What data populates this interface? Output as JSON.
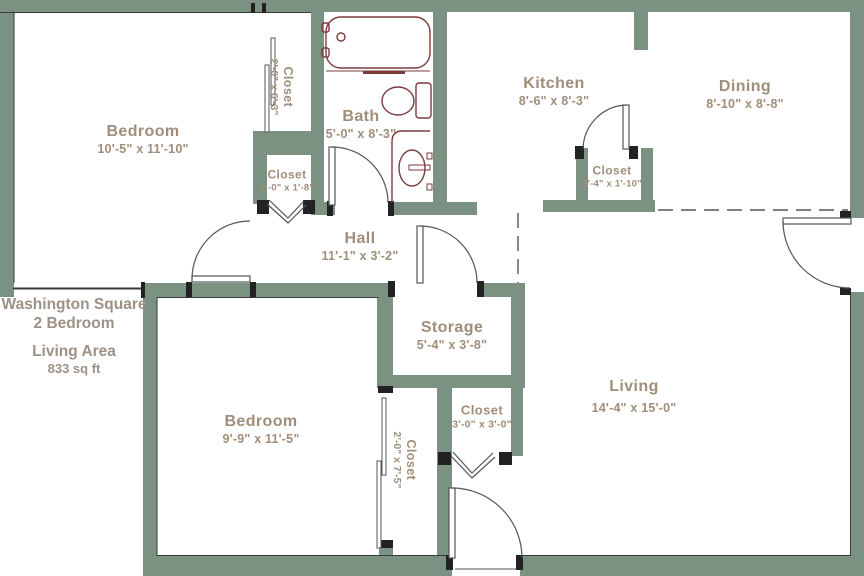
{
  "title": {
    "line1": "Washington Square",
    "line2": "2 Bedroom",
    "line3": "Living Area",
    "line4": "833 sq ft"
  },
  "rooms": {
    "bedroom1": {
      "name": "Bedroom",
      "dims": "10'-5\" x 11'-10\""
    },
    "closet1": {
      "name": "Closet",
      "dims": "2'-0\" x 6'-3\""
    },
    "closet2": {
      "name": "Closet",
      "dims": "2'-0\" x 1'-8\""
    },
    "bath": {
      "name": "Bath",
      "dims": "5'-0\" x 8'-3\""
    },
    "kitchen": {
      "name": "Kitchen",
      "dims": "8'-6\" x 8'-3\""
    },
    "kitchen_closet": {
      "name": "Closet",
      "dims": "2'-4\" x 1'-10\""
    },
    "dining": {
      "name": "Dining",
      "dims": "8'-10\" x 8'-8\""
    },
    "hall": {
      "name": "Hall",
      "dims": "11'-1\" x 3'-2\""
    },
    "storage": {
      "name": "Storage",
      "dims": "5'-4\" x 3'-8\""
    },
    "closet3": {
      "name": "Closet",
      "dims": "3'-0\" x 3'-0\""
    },
    "closet4": {
      "name": "Closet",
      "dims": "2'-0\" x 7'-5\""
    },
    "bedroom2": {
      "name": "Bedroom",
      "dims": "9'-9\" x 11'-5\""
    },
    "living": {
      "name": "Living",
      "dims": "14'-4\" x 15'-0\""
    }
  },
  "colors": {
    "wall": "#7b9181",
    "room_label": "#a08e7a",
    "title_text": "#9c9186",
    "bath_fixtures": "#7e3b3c",
    "door_lines": "#555555"
  }
}
